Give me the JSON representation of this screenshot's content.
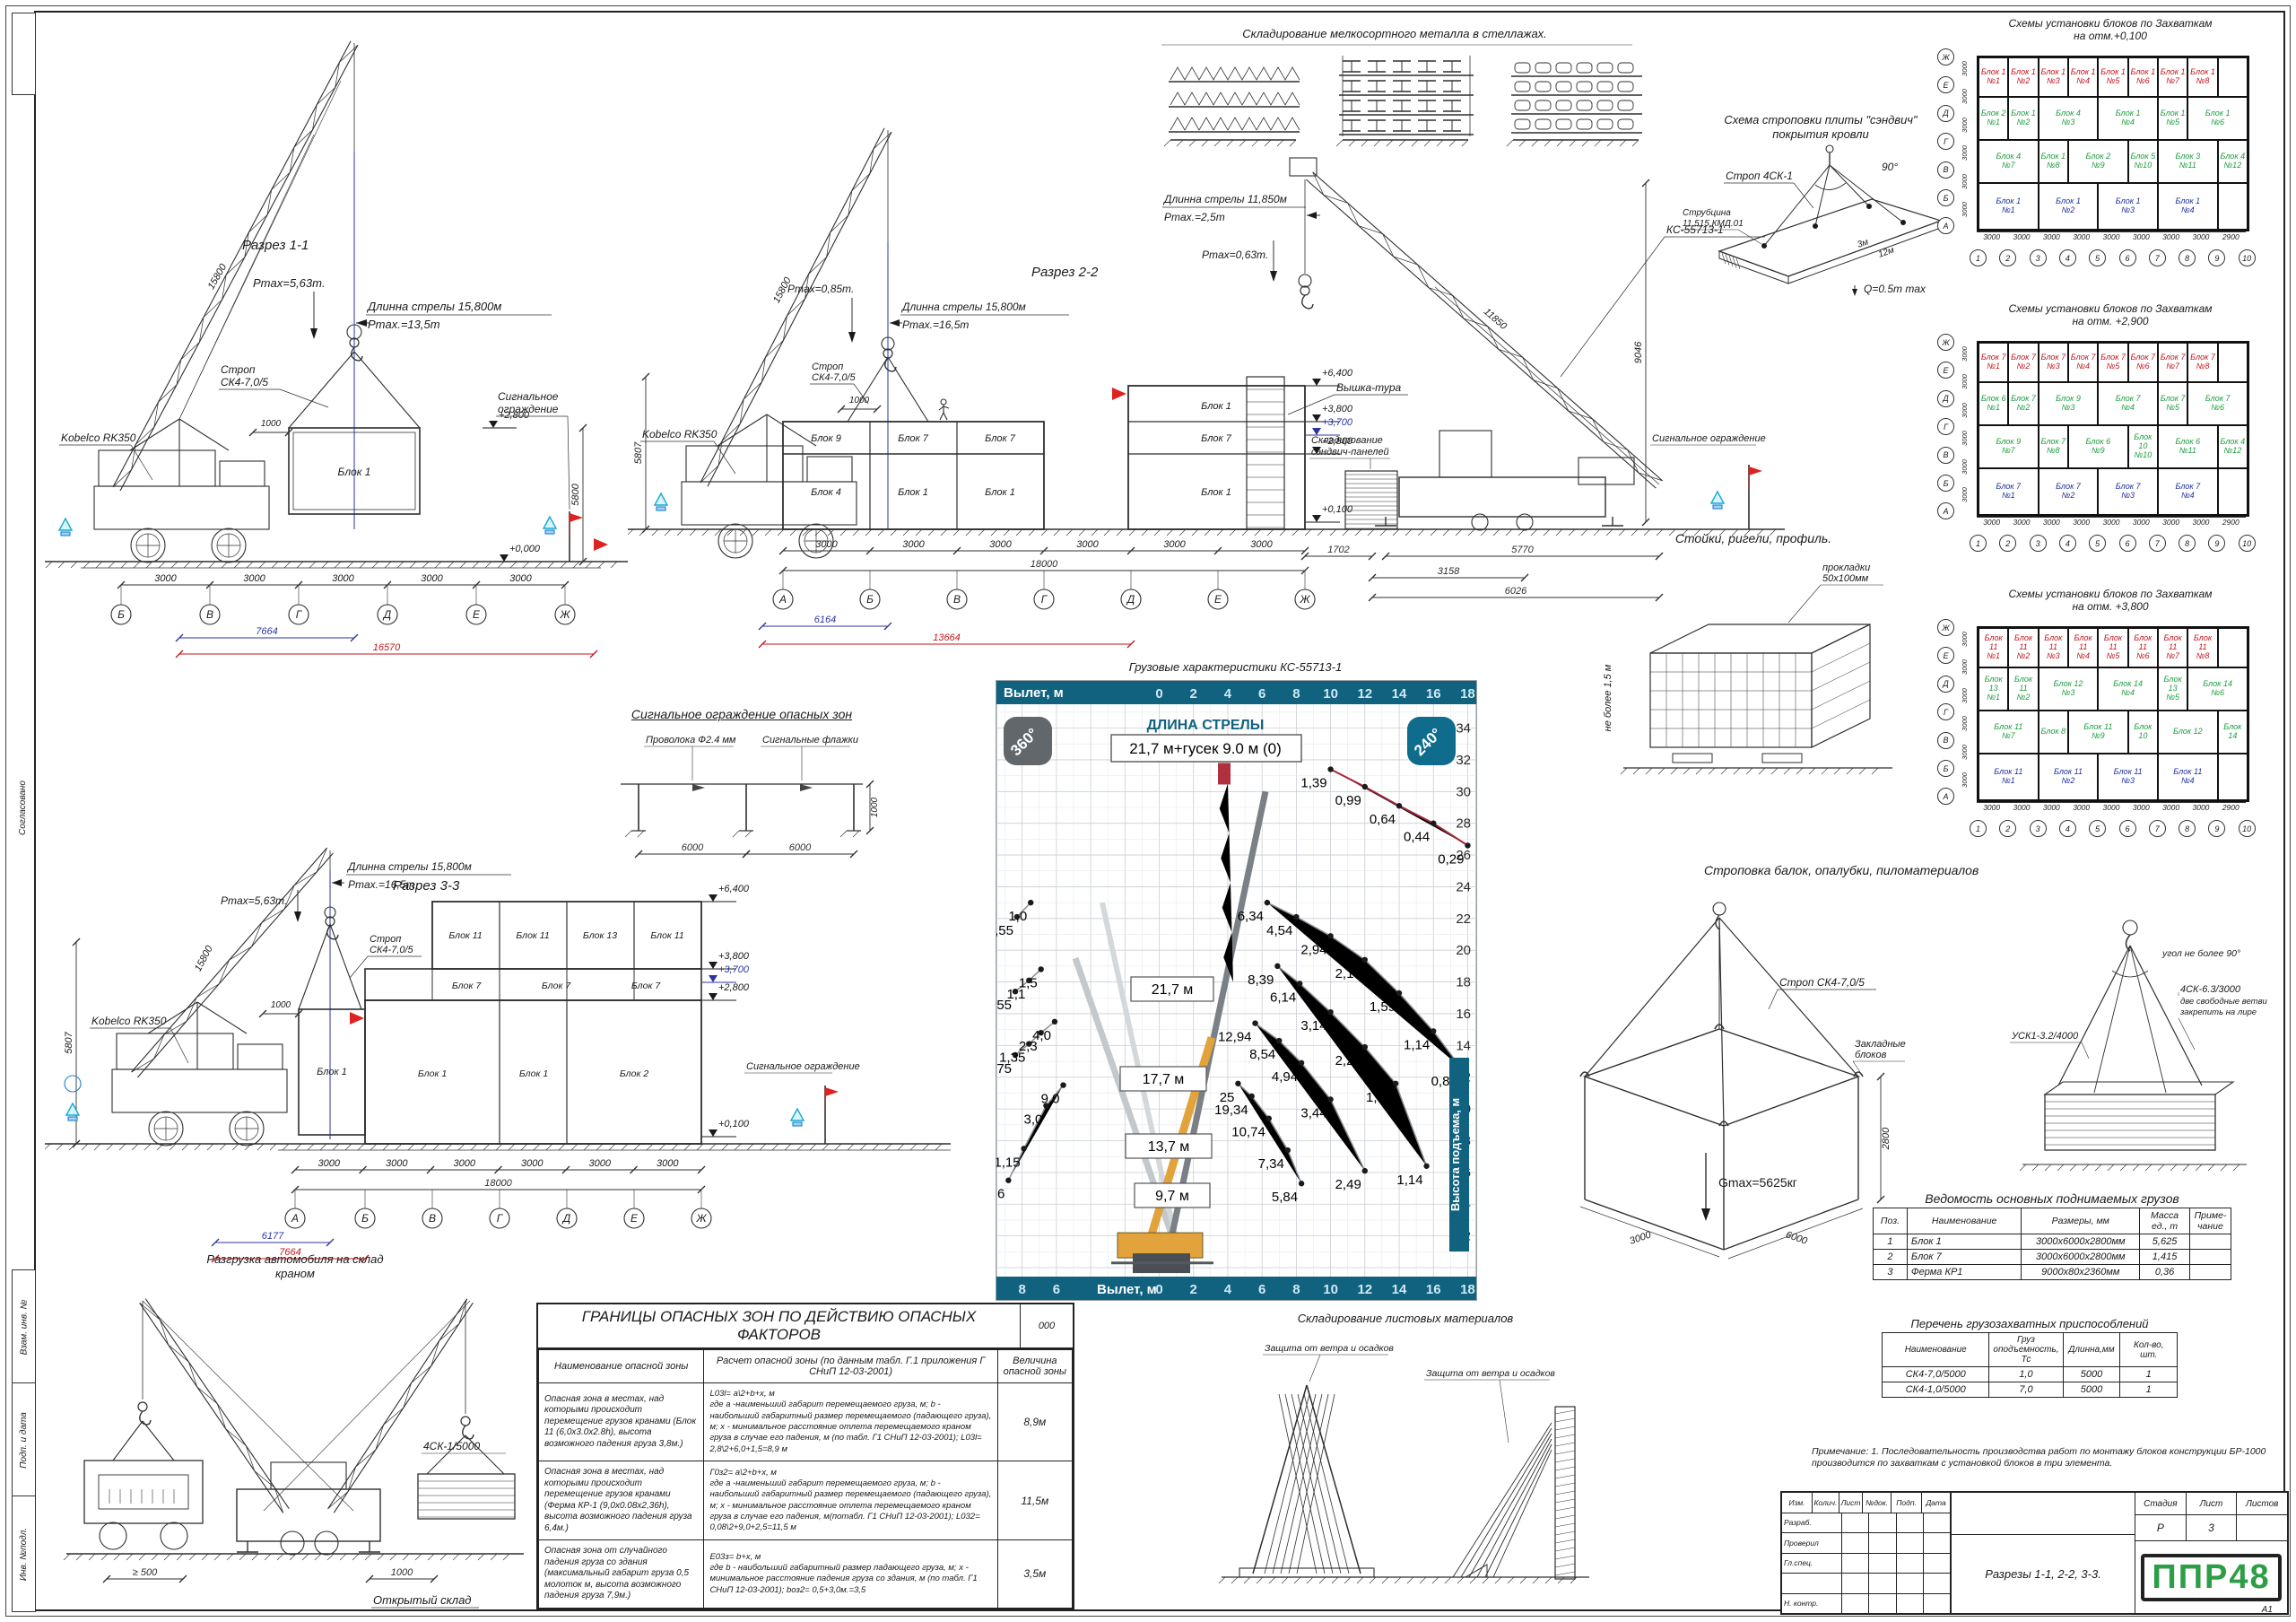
{
  "colors": {
    "red": "#c3161c",
    "blue": "#2a36a0",
    "green": "#1d9e3f",
    "band": "#10627f",
    "cyan": "#29b6d8",
    "logo": "#2e9e46"
  },
  "margin": {
    "strip1": "Согласовано",
    "strip2": "Взам. инв. №",
    "strip3": "Подп. и дата",
    "strip4": "Инв. №подл.",
    "format": "А1"
  },
  "section11": {
    "title": "Разрез 1-1",
    "crane": "Kobelco RK350",
    "boom_dim": "15800",
    "boom_note": "Длинна стрелы 15,800м",
    "radius_note": "Pmax.=13,5m",
    "pmax_note": "Pmax=5,63m.",
    "sling1": "Строп",
    "sling2": "СК4-7,0/5",
    "fence1": "Сигнальное",
    "fence2": "ограждение",
    "block": "Блок 1",
    "lvl_top": "+2,800",
    "lvl_zero": "+0,000",
    "h_dim": "5800",
    "gap_dim": "1000",
    "bays": [
      "3000",
      "3000",
      "3000",
      "3000",
      "3000"
    ],
    "axes": [
      "Б",
      "В",
      "Г",
      "Д",
      "Е",
      "Ж"
    ],
    "d_blue": "7664",
    "d_red": "16570"
  },
  "section22": {
    "title": "Разрез 2-2",
    "crane": "Kobelco RK350",
    "boom_dim": "15800",
    "h_dim": "5807",
    "boom_note": "Длинна стрелы 15,800м",
    "radius_note": "Pmax.=16,5m",
    "pmax_note": "Pmax=0,85m.",
    "sling1": "Строп",
    "sling2": "СК4-7,0/5",
    "gap_dim": "1000",
    "roof_blocks": [
      "Блок 9",
      "Блок 7",
      "Блок 7"
    ],
    "main_blocks": [
      "Блок 4",
      "Блок 1",
      "Блок 1"
    ],
    "right_blocks": [
      "Блок 1",
      "Блок 7",
      "Блок 1"
    ],
    "levels": [
      "+6,400",
      "+3,800",
      "+3,700",
      "+2,800",
      "+0,100"
    ],
    "bays": [
      "3000",
      "3000",
      "3000",
      "3000",
      "3000",
      "3000"
    ],
    "total_dim": "18000",
    "axes": [
      "А",
      "Б",
      "В",
      "Г",
      "Д",
      "Е",
      "Ж"
    ],
    "d_blue": "6164",
    "d_red": "13664",
    "tower": "Вышка-тура",
    "panels1": "Складирование",
    "panels2": "сэндвич-панелей",
    "fence": "Сигнальное ограждение",
    "crane2": "КС-55713-1",
    "boom2_note": "Длинна стрелы 11,850м",
    "radius2_note": "Pmax.=2,5m",
    "pmax2_note": "Pmax=0,63m.",
    "boom2_dim": "11850",
    "h2_dim": "9046",
    "d1": "1702",
    "d2": "3158",
    "d3": "5770",
    "d4": "6026"
  },
  "section33": {
    "title": "Разрез 3-3",
    "crane": "Kobelco RK350",
    "boom_dim": "15800",
    "h_dim": "5807",
    "boom_note": "Длинна стрелы 15,800м",
    "radius_note": "Pmax.=16,5m",
    "pmax_note": "Pmax=5,63m.",
    "sling1": "Строп",
    "sling2": "СК4-7,0/5",
    "gap_dim": "1000",
    "fence": "Сигнальное ограждение",
    "hang_block": "Блок 1",
    "row_top": [
      "Блок 11",
      "Блок 11",
      "Блок 13",
      "Блок 11"
    ],
    "row_mid": [
      "Блок 7",
      "Блок 7",
      "Блок 7"
    ],
    "row_bot": [
      "Блок 1",
      "Блок 1",
      "Блок 2"
    ],
    "levels": [
      "+6,400",
      "+3,800",
      "+3,700",
      "+2,800",
      "+0,100"
    ],
    "bays": [
      "3000",
      "3000",
      "3000",
      "3000",
      "3000",
      "3000"
    ],
    "total_dim": "18000",
    "axes": [
      "А",
      "Б",
      "В",
      "Г",
      "Д",
      "Е",
      "Ж"
    ],
    "d_blue": "6177",
    "d_red": "7664"
  },
  "metal_storage": {
    "title": "Складирование мелкосортного металла в стеллажах."
  },
  "sandwich": {
    "title1": "Схема строповки плиты \"сэндвич\"",
    "title2": "покрытия кровли",
    "sling": "Строп 4СК-1",
    "angle": "90°",
    "clamp1": "Струбцина",
    "clamp2": "11.515.КМД.01",
    "w": "3м",
    "l": "12м",
    "q": "Q=0.5m max"
  },
  "fence_detail": {
    "title": "Сигнальное ограждение опасных зон",
    "wire": "Проволока Ф2.4 мм",
    "flags": "Сигнальные флажки",
    "d1": "6000",
    "d2": "6000",
    "h": "1000"
  },
  "racks": {
    "title": "Стойки, ригели, профиль.",
    "pads1": "прокладки",
    "pads2": "50х100мм",
    "h_note": "не более 1,5 м"
  },
  "lumber": {
    "title": "Строповка балок, опалубки, пиломатериалов",
    "angle": "угол не более 90°",
    "s1": "4СК-6.3/3000",
    "s1b": "две свободные ветви",
    "s1c": "закрепить на лире",
    "s2": "УСК1-3.2/4000"
  },
  "box_sling": {
    "sling": "Строп СК4-7,0/5",
    "anch1": "Закладные",
    "anch2": "блоков",
    "gmax": "Gmax=5625кг",
    "h": "2800",
    "w": "3000",
    "l": "6000"
  },
  "unloading": {
    "title1": "Разгрузка автомобиля на склад",
    "title2": "краном",
    "sling": "4СК-1/5000",
    "d1": "≥ 500",
    "d2": "1000",
    "store": "Открытый склад"
  },
  "sheets_storage": {
    "title": "Складирование листовых материалов",
    "label1": "Защита от ветра и осадков",
    "label2": "Защита от ветра и осадков"
  },
  "schemes": {
    "main_title": "Схемы установки блоков по Захваткам",
    "col_dims": [
      "3000",
      "3000",
      "3000",
      "3000",
      "3000",
      "3000",
      "3000",
      "3000",
      "2900"
    ],
    "col_axes": [
      "1",
      "2",
      "3",
      "4",
      "5",
      "6",
      "7",
      "8",
      "9",
      "10"
    ],
    "row_axes": [
      "Ж",
      "Е",
      "Д",
      "Г",
      "В",
      "Б",
      "А"
    ],
    "row_dim": "3000",
    "items": [
      {
        "sub": "на отм.+0,100",
        "red": [
          "Блок 1|№1",
          "Блок 1|№2",
          "Блок 1|№3",
          "Блок 1|№4",
          "Блок 1|№5",
          "Блок 1|№6",
          "Блок 1|№7",
          "Блок 1|№8"
        ],
        "green": [
          "Блок 2|№1",
          "Блок 1|№2",
          "Блок 4|№3",
          "Блок 1|№4",
          "Блок 1|№5",
          "Блок 1|№6",
          "Блок 4|№7",
          "Блок 1|№8",
          "Блок 2|№9",
          "Блок 5|№10",
          "Блок 3|№11",
          "Блок 4|№12"
        ],
        "blue": [
          "Блок 1|№1",
          "Блок 1|№2",
          "Блок 1|№3",
          "Блок 1|№4"
        ]
      },
      {
        "sub": "на отм. +2,900",
        "red": [
          "Блок 7|№1",
          "Блок 7|№2",
          "Блок 7|№3",
          "Блок 7|№4",
          "Блок 7|№5",
          "Блок 7|№6",
          "Блок 7|№7",
          "Блок 7|№8"
        ],
        "green": [
          "Блок 6|№1",
          "Блок 7|№2",
          "Блок 9|№3",
          "Блок 7|№4",
          "Блок 7|№5",
          "Блок 7|№6",
          "Блок 9|№7",
          "Блок 7|№8",
          "Блок 6|№9",
          "Блок 10|№10",
          "Блок 6|№11",
          "Блок 4|№12"
        ],
        "blue": [
          "Блок 7|№1",
          "Блок 7|№2",
          "Блок 7|№3",
          "Блок 7|№4"
        ]
      },
      {
        "sub": "на отм. +3,800",
        "red": [
          "Блок 11|№1",
          "Блок 11|№2",
          "Блок 11|№3",
          "Блок 11|№4",
          "Блок 11|№5",
          "Блок 11|№6",
          "Блок 11|№7",
          "Блок 11|№8"
        ],
        "green": [
          "Блок 13|№1",
          "Блок 11|№2",
          "Блок 12|№3",
          "Блок 14|№4",
          "Блок 13|№5",
          "Блок 14|№6",
          "Блок 11|№7",
          "Блок 8|",
          "Блок 11|№9",
          "Блок 10|",
          "Блок 12|",
          "Блок 14|"
        ],
        "blue": [
          "Блок 11|№1",
          "Блок 11|№2",
          "Блок 11|№3",
          "Блок 11|№4"
        ]
      }
    ]
  },
  "chart_data": {
    "type": "line",
    "title": "Грузовые характеристики КС-55713-1",
    "header_label": "Вылет, м",
    "footer_label": "Вылет, м",
    "right_label": "Высота подъема, м",
    "boom_box_label": "ДЛИНА СТРЕЛЫ",
    "boom_box_value": "21,7 м+гусек 9.0 м (0)",
    "boom_lengths": [
      "21,7 м",
      "17,7 м",
      "13,7 м",
      "9,7 м"
    ],
    "badge_left": "360°",
    "badge_right": "240°",
    "x_ticks": [
      0,
      2,
      4,
      6,
      8,
      10,
      12,
      14,
      16,
      18
    ],
    "x_ticks_neg": [
      8,
      6
    ],
    "y_ticks": [
      2,
      4,
      6,
      8,
      10,
      12,
      14,
      16,
      18,
      20,
      22,
      24,
      26,
      28,
      30,
      32,
      34
    ],
    "xlim": [
      -9.5,
      18.5
    ],
    "ylim": [
      0,
      35.5
    ],
    "grid": true,
    "series": [
      {
        "name": "гусек 9,0 м",
        "color": "#a3273b",
        "points": [
          [
            10,
            31.4,
            "1,39"
          ],
          [
            12,
            30.3,
            "0,99"
          ],
          [
            14,
            29.1,
            "0,64"
          ],
          [
            16,
            28.0,
            "0,44"
          ],
          [
            18,
            26.6,
            "0,29"
          ]
        ]
      },
      {
        "name": "стрела 21,7 м",
        "color": "#8a8f94",
        "points": [
          [
            6.3,
            23.0,
            "6,34"
          ],
          [
            8,
            22.1,
            "4,54"
          ],
          [
            10,
            20.9,
            "2,94"
          ],
          [
            12,
            19.4,
            "2,14"
          ],
          [
            14,
            17.3,
            "1,59"
          ],
          [
            16,
            14.9,
            "1,14"
          ],
          [
            17.6,
            12.6,
            "0,84"
          ]
        ]
      },
      {
        "name": "стрела 17,7 м",
        "color": "#8a8f94",
        "points": [
          [
            6.9,
            19.0,
            "8,39"
          ],
          [
            8.2,
            17.9,
            "6,14"
          ],
          [
            10,
            16.1,
            "3,14"
          ],
          [
            12,
            13.9,
            "2,24"
          ],
          [
            13.8,
            11.6,
            "1,69"
          ],
          [
            15.6,
            6.4,
            "1,14"
          ]
        ]
      },
      {
        "name": "стрела 13,7 м",
        "color": "#8a8f94",
        "points": [
          [
            5.6,
            15.4,
            "12,94"
          ],
          [
            7,
            14.3,
            "8,54"
          ],
          [
            8.3,
            12.9,
            "4,94"
          ],
          [
            10,
            10.6,
            "3,44"
          ],
          [
            12,
            6.1,
            "2,49"
          ]
        ]
      },
      {
        "name": "стрела 9,7 м",
        "color": "#8a8f94",
        "points": [
          [
            4.6,
            11.6,
            "25"
          ],
          [
            5.4,
            10.8,
            "19,34"
          ],
          [
            6.4,
            9.4,
            "10,74"
          ],
          [
            7.5,
            7.4,
            "7,34"
          ],
          [
            8.3,
            5.3,
            "5,84"
          ]
        ]
      },
      {
        "name": "зона 240-1",
        "color": "#8a8f94",
        "points": [
          [
            -8.3,
            22.1,
            "0,55"
          ],
          [
            -7.5,
            23.0,
            "1,0"
          ]
        ]
      },
      {
        "name": "зона 240-2",
        "color": "#8a8f94",
        "points": [
          [
            -8.4,
            17.4,
            "0,55"
          ],
          [
            -7.6,
            18.1,
            "1,1"
          ],
          [
            -6.9,
            18.8,
            "1,5"
          ]
        ]
      },
      {
        "name": "зона 240-3",
        "color": "#8a8f94",
        "points": [
          [
            -8.4,
            13.4,
            "0,75"
          ],
          [
            -7.6,
            14.1,
            "1,35"
          ],
          [
            -6.9,
            14.8,
            "2,3"
          ],
          [
            -6.1,
            15.5,
            "4,0"
          ]
        ]
      },
      {
        "name": "зона 240-4",
        "color": "#8a8f94",
        "points": [
          [
            -8.8,
            5.5,
            "0,6"
          ],
          [
            -7.9,
            7.5,
            "1,15"
          ],
          [
            -6.6,
            10.2,
            "3,0"
          ],
          [
            -5.6,
            11.5,
            "9,0"
          ]
        ]
      }
    ]
  },
  "danger_table": {
    "title": "ГРАНИЦЫ ОПАСНЫХ ЗОН ПО ДЕЙСТВИЮ ОПАСНЫХ ФАКТОРОВ",
    "code": "000",
    "headers": [
      "Наименование опасной зоны",
      "Расчет опасной зоны (по данным табл. Г.1 приложения Г\nСНиП 12-03-2001)",
      "Величина\nопасной зоны"
    ],
    "rows": [
      [
        "Опасная зона в местах, над которыми происходит перемещение грузов кранами (Блок 11 (6,0х3.0х2.8h), высота возможного падения груза 3,8м.)",
        "L03l= a\\2+b+x, м\nгде а -наименьший габарит перемещаемого груза, м; b - наибольший габаритный размер перемещаемого (падающего груза), м; х - минимальное расстояние отлета перемещаемого краном груза в случае его падения, м (по табл. Г1 СНиП 12-03-2001); L03l= 2,8\\2+6,0+1,5=8,9 м",
        "8,9м"
      ],
      [
        "Опасная зона в местах, над которыми происходит перемещение грузов кранами (Ферма КР-1 (9,0х0.08х2,36h), высота возможного падения груза 6,4м.)",
        "Г0з2= a\\2+b+x, м\nгде а -наименьший габарит перемещаемого груза, м; b - наибольший габаритный размер перемещаемого (падающего груза), м; х - минимальное расстояние отлета перемещаемого краном груза в случае его падения, м(потабл. Г1 СНиП 12-03-2001); L032= 0,08\\2+9,0+2,5=11,5 м",
        "11,5м"
      ],
      [
        "Опасная зона от случайного падения груза со здания (максимальный габарит груза 0,5 молоток м, высота возможного падения груза 7,9м.)",
        "Е03з= b+x, м\nгде b - наибольший габаритный размер падающего груза, м; х - минимальное расстояние падения груза со здания, м (по табл. Г1 СНиП 12-03-2001); bоз2= 0,5+3,0м.=3,5",
        "3,5м"
      ]
    ]
  },
  "loads_table": {
    "title": "Ведомость основных поднимаемых грузов",
    "headers": [
      "Поз.",
      "Наименование",
      "Размеры, мм",
      "Масса\nед., т",
      "Приме-\nчание"
    ],
    "rows": [
      [
        "1",
        "Блок 1",
        "3000х6000х2800мм",
        "5,625",
        ""
      ],
      [
        "2",
        "Блок 7",
        "3000х6000х2800мм",
        "1,415",
        ""
      ],
      [
        "3",
        "Ферма КР1",
        "9000х80х2360мм",
        "0,36",
        ""
      ]
    ]
  },
  "rigging_table": {
    "title": "Перечень грузозахватных приспособлений",
    "headers": [
      "Наименование",
      "Груз\nоподъемность,\nТс",
      "Длинна,мм",
      "Кол-во, шт."
    ],
    "rows": [
      [
        "СК4-7,0/5000",
        "1,0",
        "5000",
        "1"
      ],
      [
        "СК4-1,0/5000",
        "7,0",
        "5000",
        "1"
      ]
    ]
  },
  "note": {
    "label": "Примечание:",
    "text": "1. Последовательность производства работ по монтажу блоков конструкции БР-1000 производится по захваткам с установкой блоков в три элемента."
  },
  "titleblock": {
    "cols": [
      "Изм.",
      "Колич.",
      "Лист",
      "№док.",
      "Подп.",
      "Дата"
    ],
    "roles": [
      "Разраб.",
      "Проверил",
      "Гл.спец.",
      "",
      "Н. контр."
    ],
    "doc_title": "Разрезы 1-1, 2-2, 3-3.",
    "stage_label": "Стадия",
    "sheet_label": "Лист",
    "sheets_label": "Листов",
    "stage": "Р",
    "sheet": "3",
    "sheets": "",
    "logo": "ППР48"
  }
}
